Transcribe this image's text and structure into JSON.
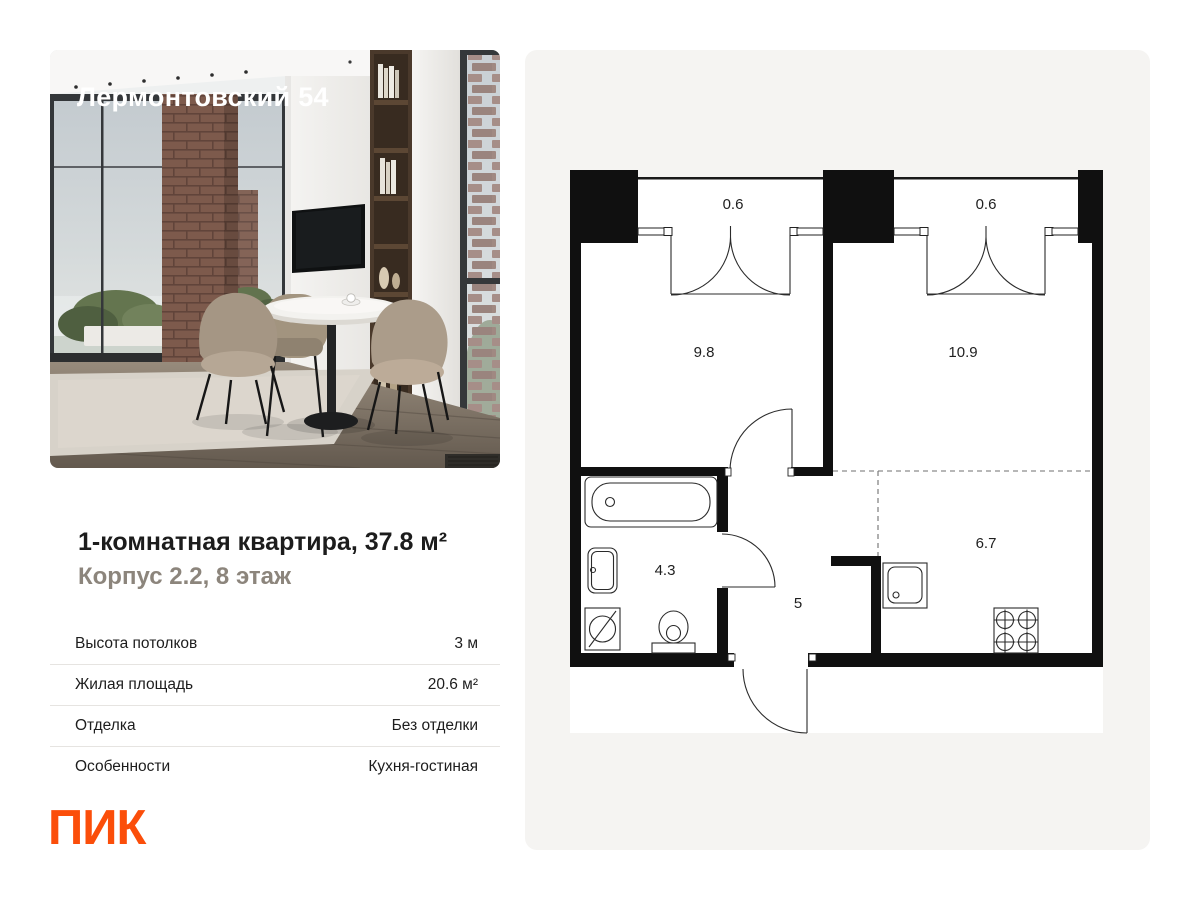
{
  "photo": {
    "overlay_title": "Лермонтовский 54"
  },
  "listing": {
    "title": "1-комнатная квартира, 37.8 м²",
    "subtitle": "Корпус 2.2, 8 этаж",
    "specs": [
      {
        "label": "Высота потолков",
        "value": "3 м"
      },
      {
        "label": "Жилая площадь",
        "value": "20.6 м²"
      },
      {
        "label": "Отделка",
        "value": "Без отделки"
      },
      {
        "label": "Особенности",
        "value": "Кухня-гостиная"
      }
    ]
  },
  "brand": {
    "logo_text": "ПИК",
    "accent_color": "#FB4E0A"
  },
  "colors": {
    "panel_bg": "#f5f4f2",
    "wall": "#101010",
    "subtitle": "#8c857c"
  },
  "floorplan": {
    "rooms": [
      {
        "name": "balcony-left",
        "area": "0.6"
      },
      {
        "name": "balcony-right",
        "area": "0.6"
      },
      {
        "name": "bedroom",
        "area": "9.8"
      },
      {
        "name": "living-room",
        "area": "10.9"
      },
      {
        "name": "bathroom",
        "area": "4.3"
      },
      {
        "name": "hallway",
        "area": "5"
      },
      {
        "name": "kitchen",
        "area": "6.7"
      }
    ]
  }
}
